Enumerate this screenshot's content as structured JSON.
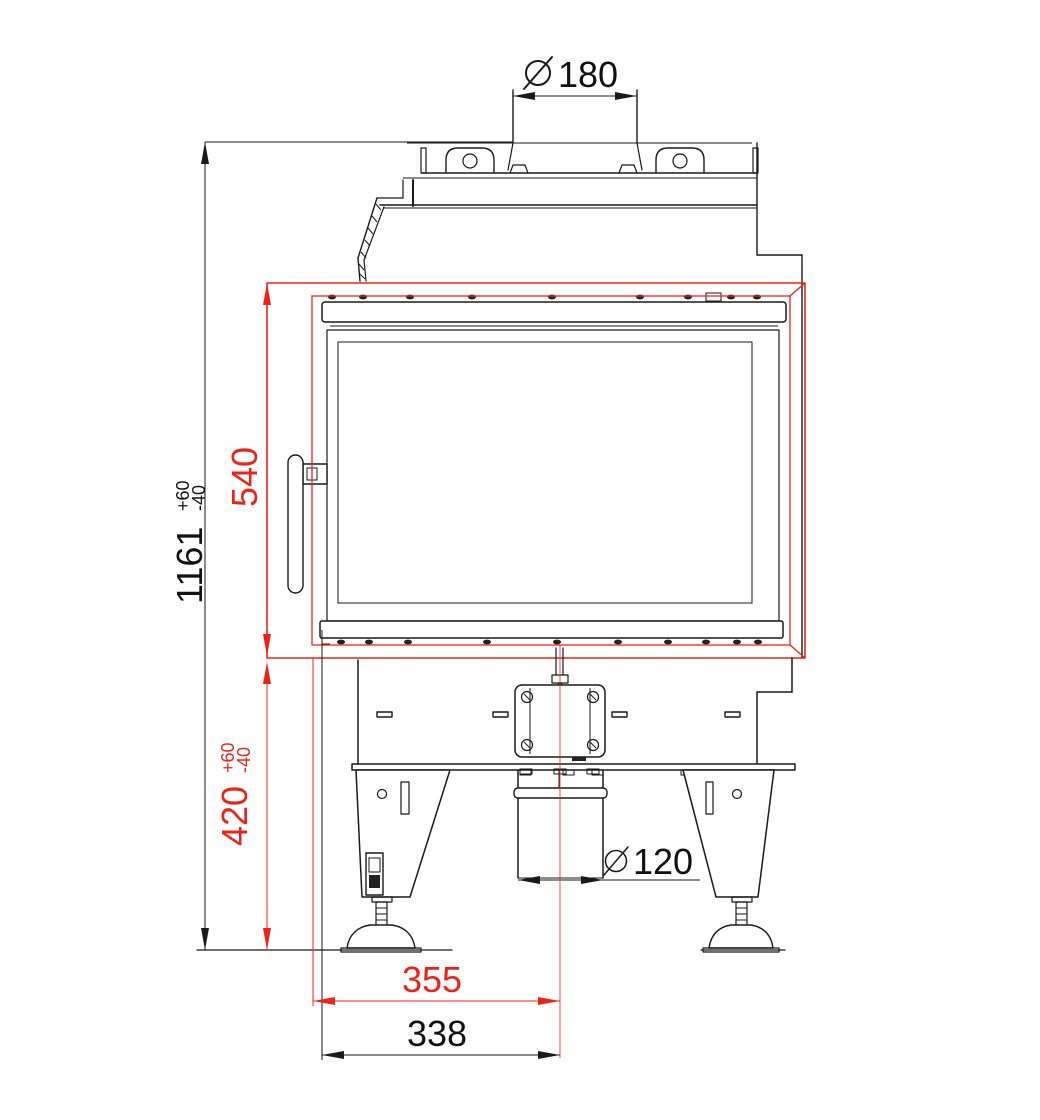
{
  "drawing": {
    "type": "technical-dimension-drawing",
    "subject": "fireplace-insert-front-elevation",
    "colors": {
      "line": "#1a1a1a",
      "dimension_red": "#ed2317",
      "background": "#ffffff"
    }
  },
  "dims": {
    "flue_diameter": {
      "symbol": "diameter",
      "value": "180"
    },
    "overall_height": {
      "value": "1161",
      "tol_plus": "+60",
      "tol_minus": "-40"
    },
    "door_height": {
      "value": "540"
    },
    "base_height": {
      "value": "420",
      "tol_plus": "+60",
      "tol_minus": "-40"
    },
    "offset_red": {
      "value": "355"
    },
    "offset_black": {
      "value": "338"
    },
    "intake_diameter": {
      "symbol": "diameter",
      "value": "120"
    }
  }
}
